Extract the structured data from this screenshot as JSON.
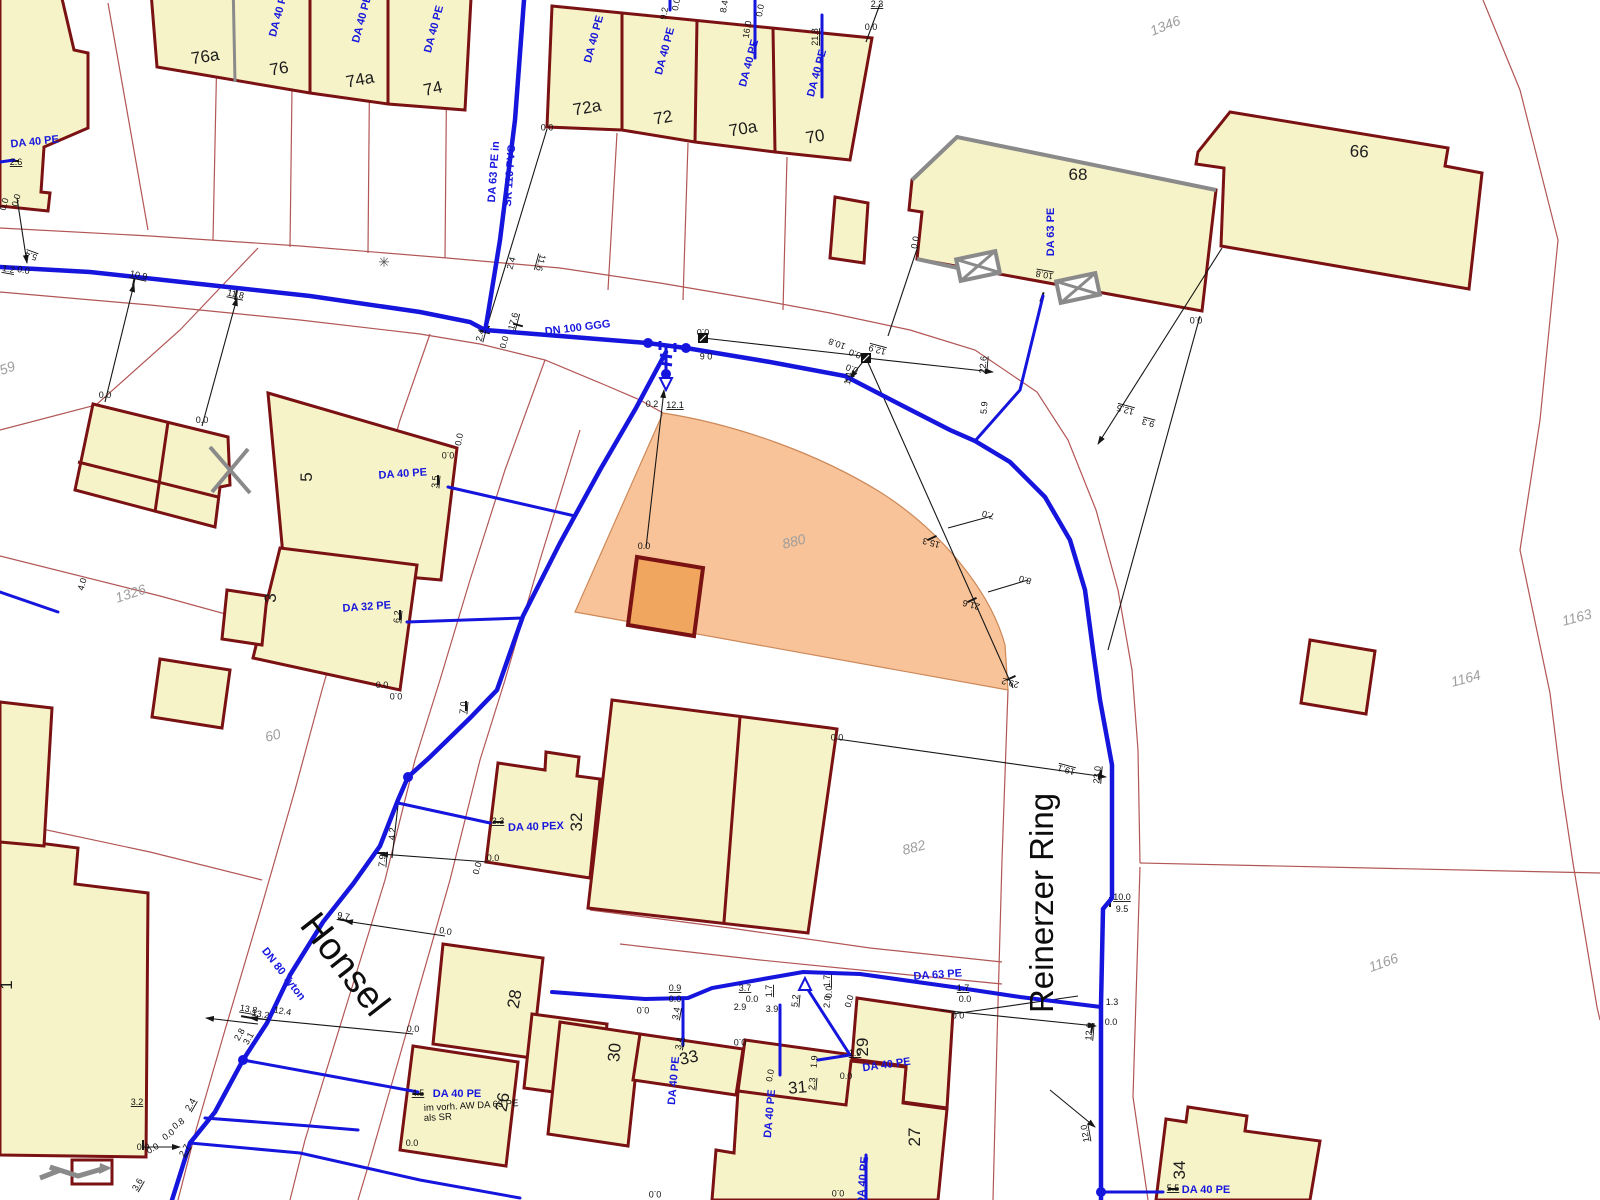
{
  "map": {
    "title": "Wasserleitungs-Bestandsplan",
    "colors": {
      "background": "#ffffff",
      "building_fill": "#f7f3c8",
      "building_stroke": "#7a1113",
      "building_gray_edge": "#8a8a8a",
      "highlight_parcel_fill": "#f8c398",
      "highlight_parcel_stroke": "#cc8858",
      "highlight_building_fill": "#f0a65f",
      "pipe_blue": "#1515dd",
      "boundary_red": "#b25555",
      "survey_black": "#161616",
      "parcel_text": "#9d9d9d"
    },
    "street_names": [
      {
        "text": "Honsel",
        "x": 335,
        "y": 972,
        "rot": 52,
        "size": 38
      },
      {
        "text": "Reinerzer Ring",
        "x": 1053,
        "y": 903,
        "rot": -90,
        "size": 33
      }
    ],
    "parcel_numbers": [
      {
        "text": "1346",
        "x": 1167,
        "y": 30,
        "rot": -22
      },
      {
        "text": "1159",
        "x": 2,
        "y": 375,
        "rot": -20
      },
      {
        "text": "1326",
        "x": 132,
        "y": 598,
        "rot": -18
      },
      {
        "text": "60",
        "x": 274,
        "y": 740,
        "rot": -15
      },
      {
        "text": "880",
        "x": 795,
        "y": 546,
        "rot": -14,
        "size": 16
      },
      {
        "text": "882",
        "x": 915,
        "y": 852,
        "rot": -15
      },
      {
        "text": "1164",
        "x": 1467,
        "y": 683,
        "rot": -15
      },
      {
        "text": "1163",
        "x": 1578,
        "y": 622,
        "rot": -15
      },
      {
        "text": "1166",
        "x": 1385,
        "y": 967,
        "rot": -20
      }
    ],
    "house_numbers": [
      {
        "text": "76a",
        "x": 206,
        "y": 62,
        "rot": -9
      },
      {
        "text": "76",
        "x": 280,
        "y": 74,
        "rot": -10
      },
      {
        "text": "74a",
        "x": 361,
        "y": 85,
        "rot": -11
      },
      {
        "text": "74",
        "x": 434,
        "y": 94,
        "rot": -12
      },
      {
        "text": "72a",
        "x": 588,
        "y": 113,
        "rot": -10
      },
      {
        "text": "72",
        "x": 664,
        "y": 123,
        "rot": -10
      },
      {
        "text": "70a",
        "x": 744,
        "y": 134,
        "rot": -10
      },
      {
        "text": "70",
        "x": 816,
        "y": 142,
        "rot": -10
      },
      {
        "text": "68",
        "x": 1078,
        "y": 180,
        "rot": 0
      },
      {
        "text": "66",
        "x": 1359,
        "y": 157,
        "rot": 3
      },
      {
        "text": "5",
        "x": 312,
        "y": 477,
        "rot": -90
      },
      {
        "text": "3",
        "x": 276,
        "y": 598,
        "rot": -90
      },
      {
        "text": "32",
        "x": 582,
        "y": 822,
        "rot": -90
      },
      {
        "text": "28",
        "x": 520,
        "y": 1000,
        "rot": -80
      },
      {
        "text": "26",
        "x": 508,
        "y": 1103,
        "rot": -80
      },
      {
        "text": "30",
        "x": 620,
        "y": 1053,
        "rot": -85
      },
      {
        "text": "33",
        "x": 690,
        "y": 1063,
        "rot": -12
      },
      {
        "text": "31",
        "x": 798,
        "y": 1093,
        "rot": -5
      },
      {
        "text": "29",
        "x": 868,
        "y": 1047,
        "rot": -90
      },
      {
        "text": "27",
        "x": 920,
        "y": 1137,
        "rot": -90
      },
      {
        "text": "34",
        "x": 1185,
        "y": 1170,
        "rot": -90
      },
      {
        "text": "1",
        "x": 12,
        "y": 985,
        "rot": -90
      }
    ],
    "pipe_labels": [
      {
        "text": "DA 40 PE",
        "x": 282,
        "y": 14,
        "rot": -75
      },
      {
        "text": "DA 40 PE",
        "x": 365,
        "y": 20,
        "rot": -75
      },
      {
        "text": "DA 40 PE",
        "x": 437,
        "y": 30,
        "rot": -75
      },
      {
        "text": "DA 40 PE",
        "x": 597,
        "y": 40,
        "rot": -75
      },
      {
        "text": "DA 40 PE",
        "x": 668,
        "y": 52,
        "rot": -75
      },
      {
        "text": "DA 40 PE",
        "x": 752,
        "y": 64,
        "rot": -75
      },
      {
        "text": "DA 40 PE",
        "x": 820,
        "y": 74,
        "rot": -75
      },
      {
        "text": "DA 40 PE",
        "x": 35,
        "y": 145,
        "rot": -6
      },
      {
        "text": "DA 63 PE in",
        "x": 497,
        "y": 172,
        "rot": -86
      },
      {
        "text": "SR 110 PVC",
        "x": 513,
        "y": 176,
        "rot": -86
      },
      {
        "text": "DN 100 GGG",
        "x": 578,
        "y": 331,
        "rot": -7
      },
      {
        "text": "DA 63 PE",
        "x": 1054,
        "y": 232,
        "rot": -90
      },
      {
        "text": "DA 40 PE",
        "x": 403,
        "y": 477,
        "rot": -4
      },
      {
        "text": "DA 32 PE",
        "x": 367,
        "y": 610,
        "rot": -4
      },
      {
        "text": "DA 40 PEX",
        "x": 536,
        "y": 830,
        "rot": -2
      },
      {
        "text": "DN 80 Tyton",
        "x": 281,
        "y": 976,
        "rot": 52
      },
      {
        "text": "DA 40 PE",
        "x": 457,
        "y": 1097,
        "rot": 0
      },
      {
        "text": "DA 63 PE",
        "x": 938,
        "y": 978,
        "rot": -4
      },
      {
        "text": "DA 40 PE",
        "x": 677,
        "y": 1081,
        "rot": -85
      },
      {
        "text": "DA 40 PE",
        "x": 773,
        "y": 1114,
        "rot": -85
      },
      {
        "text": "DA 40 PE",
        "x": 887,
        "y": 1068,
        "rot": -8
      },
      {
        "text": "DA 40 PE",
        "x": 866,
        "y": 1181,
        "rot": -85
      },
      {
        "text": "DA 40 PE",
        "x": 1206,
        "y": 1193,
        "rot": 0
      }
    ],
    "notes": [
      {
        "text": "im vorh. AW DA 63 PE",
        "x": 424,
        "y": 1111,
        "rot": -3
      },
      {
        "text": "als SR",
        "x": 424,
        "y": 1121,
        "rot": -3
      }
    ],
    "measurements": [
      {
        "text": "2.6",
        "x": 16,
        "y": 165,
        "rot": 0,
        "u": 1
      },
      {
        "text": "0.0",
        "x": 7,
        "y": 205,
        "rot": -75
      },
      {
        "text": "0.0",
        "x": 19,
        "y": 201,
        "rot": -75
      },
      {
        "text": "5.4",
        "x": 32,
        "y": 253,
        "rot": 200,
        "u": 1
      },
      {
        "text": "1.2",
        "x": 8,
        "y": 272,
        "rot": 10,
        "u": 1
      },
      {
        "text": "0.0",
        "x": 23,
        "y": 273,
        "rot": 10
      },
      {
        "text": "10.9",
        "x": 138,
        "y": 278,
        "rot": 12,
        "u": 1
      },
      {
        "text": "11.8",
        "x": 235,
        "y": 297,
        "rot": 12,
        "u": 1
      },
      {
        "text": "9.2",
        "x": 667,
        "y": 14,
        "rot": -80
      },
      {
        "text": "0.0",
        "x": 679,
        "y": 5,
        "rot": -80
      },
      {
        "text": "8.4",
        "x": 727,
        "y": 7,
        "rot": -80
      },
      {
        "text": "16.0",
        "x": 750,
        "y": 30,
        "rot": -80
      },
      {
        "text": "0.0",
        "x": 763,
        "y": 11,
        "rot": -80
      },
      {
        "text": "21.8",
        "x": 818,
        "y": 37,
        "rot": -90,
        "u": 1
      },
      {
        "text": "2.3",
        "x": 877,
        "y": 7,
        "rot": 0,
        "u": 1
      },
      {
        "text": "0.0",
        "x": 871,
        "y": 30,
        "rot": 0
      },
      {
        "text": "0.0",
        "x": 547,
        "y": 124,
        "rot": 180
      },
      {
        "text": "2.4",
        "x": 483,
        "y": 336,
        "rot": -75,
        "u": 1
      },
      {
        "text": "17.6",
        "x": 516,
        "y": 322,
        "rot": -75,
        "u": 1
      },
      {
        "text": "0.0",
        "x": 507,
        "y": 343,
        "rot": -75
      },
      {
        "text": "2.4",
        "x": 514,
        "y": 264,
        "rot": -75
      },
      {
        "text": "11.6",
        "x": 538,
        "y": 262,
        "rot": 105,
        "u": 1
      },
      {
        "text": "0.0",
        "x": 703,
        "y": 329,
        "rot": 180
      },
      {
        "text": "0.6",
        "x": 706,
        "y": 353,
        "rot": 180
      },
      {
        "text": "0.0",
        "x": 918,
        "y": 243,
        "rot": -80
      },
      {
        "text": "10.8",
        "x": 1045,
        "y": 272,
        "rot": 190,
        "u": 1
      },
      {
        "text": "0.0",
        "x": 1196,
        "y": 317,
        "rot": 180
      },
      {
        "text": "22.6",
        "x": 986,
        "y": 365,
        "rot": -85,
        "u": 1
      },
      {
        "text": "10.8",
        "x": 838,
        "y": 341,
        "rot": 200
      },
      {
        "text": "0.0",
        "x": 856,
        "y": 351,
        "rot": 200
      },
      {
        "text": "12.9",
        "x": 878,
        "y": 347,
        "rot": 195,
        "u": 1
      },
      {
        "text": "1.4",
        "x": 851,
        "y": 379,
        "rot": -80
      },
      {
        "text": "0.0",
        "x": 853,
        "y": 366,
        "rot": 200
      },
      {
        "text": "5.9",
        "x": 987,
        "y": 408,
        "rot": -85
      },
      {
        "text": "12.5",
        "x": 1126,
        "y": 407,
        "rot": 195,
        "u": 1
      },
      {
        "text": "9.3",
        "x": 1149,
        "y": 420,
        "rot": 195,
        "u": 1
      },
      {
        "text": "0.2",
        "x": 652,
        "y": 407,
        "rot": 0
      },
      {
        "text": "12.1",
        "x": 675,
        "y": 408,
        "rot": 0,
        "u": 1
      },
      {
        "text": "0.0",
        "x": 644,
        "y": 549,
        "rot": 0
      },
      {
        "text": "15.3",
        "x": 932,
        "y": 540,
        "rot": 195
      },
      {
        "text": "21.6",
        "x": 972,
        "y": 602,
        "rot": 195
      },
      {
        "text": "29.2",
        "x": 1011,
        "y": 680,
        "rot": 195
      },
      {
        "text": "7.0",
        "x": 989,
        "y": 512,
        "rot": 195
      },
      {
        "text": "8.0",
        "x": 1026,
        "y": 577,
        "rot": 195
      },
      {
        "text": "0.0",
        "x": 105,
        "y": 398,
        "rot": 0
      },
      {
        "text": "0.0",
        "x": 202,
        "y": 423,
        "rot": 0
      },
      {
        "text": "3.5",
        "x": 438,
        "y": 482,
        "rot": -85,
        "u": 1
      },
      {
        "text": "0.0",
        "x": 448,
        "y": 452,
        "rot": 180
      },
      {
        "text": "0.0",
        "x": 462,
        "y": 440,
        "rot": -80
      },
      {
        "text": "6.2",
        "x": 400,
        "y": 617,
        "rot": -85,
        "u": 1
      },
      {
        "text": "0.0",
        "x": 382,
        "y": 688,
        "rot": 0
      },
      {
        "text": "0.0",
        "x": 396,
        "y": 693,
        "rot": 180
      },
      {
        "text": "7.0",
        "x": 466,
        "y": 708,
        "rot": -85,
        "u": 1
      },
      {
        "text": "4.0",
        "x": 85,
        "y": 585,
        "rot": -75
      },
      {
        "text": "3.3",
        "x": 498,
        "y": 824,
        "rot": 0,
        "u": 1
      },
      {
        "text": "4.2",
        "x": 395,
        "y": 834,
        "rot": -85
      },
      {
        "text": "7.9",
        "x": 385,
        "y": 861,
        "rot": -85,
        "u": 1
      },
      {
        "text": "0.0",
        "x": 493,
        "y": 861,
        "rot": 0
      },
      {
        "text": "0.0",
        "x": 480,
        "y": 869,
        "rot": -75
      },
      {
        "text": "0.0",
        "x": 837,
        "y": 734,
        "rot": 180
      },
      {
        "text": "9.7",
        "x": 343,
        "y": 919,
        "rot": 10,
        "u": 1
      },
      {
        "text": "0.0",
        "x": 445,
        "y": 934,
        "rot": 10
      },
      {
        "text": "13.8",
        "x": 248,
        "y": 1012,
        "rot": 10,
        "u": 1
      },
      {
        "text": "13.2",
        "x": 260,
        "y": 1017,
        "rot": 10,
        "u": 1
      },
      {
        "text": "12.4",
        "x": 282,
        "y": 1014,
        "rot": 10
      },
      {
        "text": "2.8",
        "x": 242,
        "y": 1036,
        "rot": -60
      },
      {
        "text": "3.1",
        "x": 251,
        "y": 1040,
        "rot": -60
      },
      {
        "text": "2.4",
        "x": 193,
        "y": 1106,
        "rot": -60,
        "u": 1
      },
      {
        "text": "2.7",
        "x": 187,
        "y": 1152,
        "rot": -60,
        "u": 1
      },
      {
        "text": "4.5",
        "x": 418,
        "y": 1096,
        "rot": 0,
        "u": 1
      },
      {
        "text": "0.0",
        "x": 413,
        "y": 1032,
        "rot": 0
      },
      {
        "text": "0.0",
        "x": 412,
        "y": 1146,
        "rot": 0
      },
      {
        "text": "0.9",
        "x": 675,
        "y": 991,
        "rot": 0,
        "u": 1
      },
      {
        "text": "0.0",
        "x": 675,
        "y": 1002,
        "rot": 0
      },
      {
        "text": "3.4",
        "x": 679,
        "y": 1014,
        "rot": -80,
        "u": 1
      },
      {
        "text": "3.4",
        "x": 682,
        "y": 1044,
        "rot": -80,
        "u": 1
      },
      {
        "text": "3.7",
        "x": 745,
        "y": 991,
        "rot": 0,
        "u": 1
      },
      {
        "text": "0.0",
        "x": 752,
        "y": 1002,
        "rot": 0
      },
      {
        "text": "2.9",
        "x": 740,
        "y": 1010,
        "rot": 0
      },
      {
        "text": "3.9",
        "x": 772,
        "y": 1012,
        "rot": 0
      },
      {
        "text": "1.7",
        "x": 772,
        "y": 991,
        "rot": -90,
        "u": 1
      },
      {
        "text": "5.2",
        "x": 798,
        "y": 1001,
        "rot": -85,
        "u": 1
      },
      {
        "text": "1.7",
        "x": 830,
        "y": 981,
        "rot": -90,
        "u": 1
      },
      {
        "text": "0.0",
        "x": 832,
        "y": 992,
        "rot": -90
      },
      {
        "text": "2.0",
        "x": 830,
        "y": 1002,
        "rot": -85
      },
      {
        "text": "0.0",
        "x": 852,
        "y": 1002,
        "rot": -75
      },
      {
        "text": "1.9",
        "x": 855,
        "y": 1056,
        "rot": 0,
        "u": 1
      },
      {
        "text": "1.9",
        "x": 817,
        "y": 1062,
        "rot": -85
      },
      {
        "text": "2.3",
        "x": 815,
        "y": 1084,
        "rot": -85,
        "u": 1
      },
      {
        "text": "0.0",
        "x": 846,
        "y": 1079,
        "rot": 0
      },
      {
        "text": "0.0",
        "x": 643,
        "y": 1007,
        "rot": 180
      },
      {
        "text": "0.0",
        "x": 740,
        "y": 1039,
        "rot": 180
      },
      {
        "text": "0.0",
        "x": 773,
        "y": 1076,
        "rot": -80
      },
      {
        "text": "1.7",
        "x": 963,
        "y": 991,
        "rot": 0,
        "u": 1
      },
      {
        "text": "0.0",
        "x": 965,
        "y": 1002,
        "rot": 0
      },
      {
        "text": "0.0",
        "x": 958,
        "y": 1012,
        "rot": 180
      },
      {
        "text": "19.1",
        "x": 1067,
        "y": 767,
        "rot": 195,
        "u": 1
      },
      {
        "text": "23.0",
        "x": 1100,
        "y": 775,
        "rot": -85,
        "u": 1
      },
      {
        "text": "10.0",
        "x": 1122,
        "y": 900,
        "rot": 0,
        "u": 1
      },
      {
        "text": "9.5",
        "x": 1122,
        "y": 912,
        "rot": 0
      },
      {
        "text": "1.3",
        "x": 1112,
        "y": 1005,
        "rot": 0
      },
      {
        "text": "0.0",
        "x": 1111,
        "y": 1025,
        "rot": 0
      },
      {
        "text": "12.0",
        "x": 1092,
        "y": 1032,
        "rot": -85,
        "u": 1
      },
      {
        "text": "12.0",
        "x": 1088,
        "y": 1133,
        "rot": -100,
        "u": 1
      },
      {
        "text": "5.5",
        "x": 1173,
        "y": 1191,
        "rot": 0,
        "u": 1
      },
      {
        "text": "3.2",
        "x": 137,
        "y": 1105,
        "rot": 0,
        "u": 1
      },
      {
        "text": "0.8",
        "x": 180,
        "y": 1126,
        "rot": -35
      },
      {
        "text": "0.0",
        "x": 170,
        "y": 1137,
        "rot": -35
      },
      {
        "text": "3.6",
        "x": 140,
        "y": 1186,
        "rot": -60,
        "u": 1
      },
      {
        "text": "0.0",
        "x": 143,
        "y": 1150,
        "rot": 0
      },
      {
        "text": "0.0",
        "x": 154,
        "y": 1151,
        "rot": -30
      },
      {
        "text": "0.0",
        "x": 838,
        "y": 1190,
        "rot": 180
      },
      {
        "text": "0.0",
        "x": 655,
        "y": 1191,
        "rot": 180
      }
    ],
    "symbols": [
      {
        "name": "streetlight-icon",
        "x": 384,
        "y": 262
      },
      {
        "name": "valve-box-icon",
        "x": 703,
        "y": 338
      },
      {
        "name": "valve-box-icon",
        "x": 866,
        "y": 358
      },
      {
        "name": "garage-cross-icon",
        "x": 978,
        "y": 266
      },
      {
        "name": "garage-cross-icon",
        "x": 1078,
        "y": 288
      },
      {
        "name": "hydrant-icon",
        "x": 666,
        "y": 384
      },
      {
        "name": "hydrant-icon",
        "x": 805,
        "y": 984
      },
      {
        "name": "gray-cross-icon",
        "x": 230,
        "y": 470
      },
      {
        "name": "flow-arrow-icon",
        "x": 92,
        "y": 1172
      }
    ]
  }
}
